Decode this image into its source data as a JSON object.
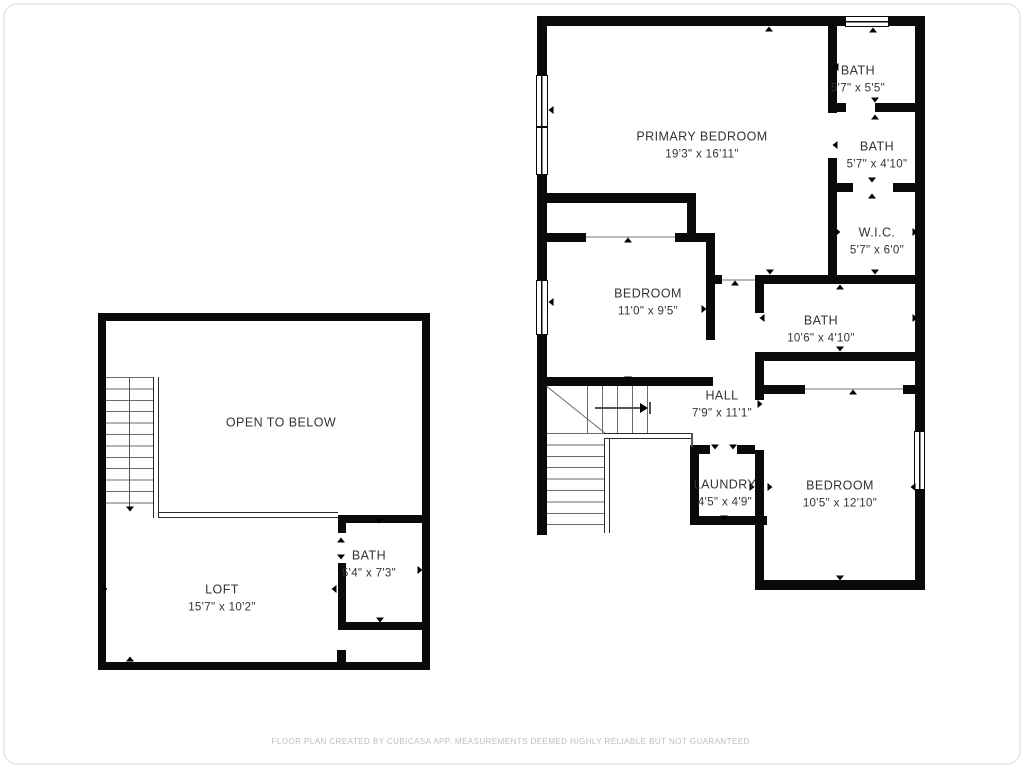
{
  "colors": {
    "wall": "#0a0a0a",
    "label_text": "#333333",
    "footer_text": "#bdbdbd"
  },
  "upper_floor": {
    "rooms": {
      "primary_bedroom": {
        "name": "PRIMARY BEDROOM",
        "dims": "19'3\" x 16'11\""
      },
      "bath_top": {
        "name": "BATH",
        "dims": "5'7\" x 5'5\""
      },
      "bath_mid": {
        "name": "BATH",
        "dims": "5'7\" x 4'10\""
      },
      "wic": {
        "name": "W.I.C.",
        "dims": "5'7\" x 6'0\""
      },
      "bath_hall": {
        "name": "BATH",
        "dims": "10'6\" x 4'10\""
      },
      "bedroom_mid": {
        "name": "BEDROOM",
        "dims": "11'0\" x 9'5\""
      },
      "hall": {
        "name": "HALL",
        "dims": "7'9\" x 11'1\""
      },
      "laundry": {
        "name": "LAUNDRY",
        "dims": "4'5\" x 4'9\""
      },
      "bedroom_bottom": {
        "name": "BEDROOM",
        "dims": "10'5\" x 12'10\""
      }
    }
  },
  "loft_floor": {
    "open_label": "OPEN TO BELOW",
    "rooms": {
      "loft": {
        "name": "LOFT",
        "dims": "15'7\" x 10'2\""
      },
      "bath_loft": {
        "name": "BATH",
        "dims": "5'4\" x 7'3\""
      }
    }
  },
  "footer": {
    "disclaimer": "FLOOR PLAN CREATED BY CUBICASA APP. MEASUREMENTS DEEMED HIGHLY RELIABLE BUT NOT GUARANTEED."
  }
}
